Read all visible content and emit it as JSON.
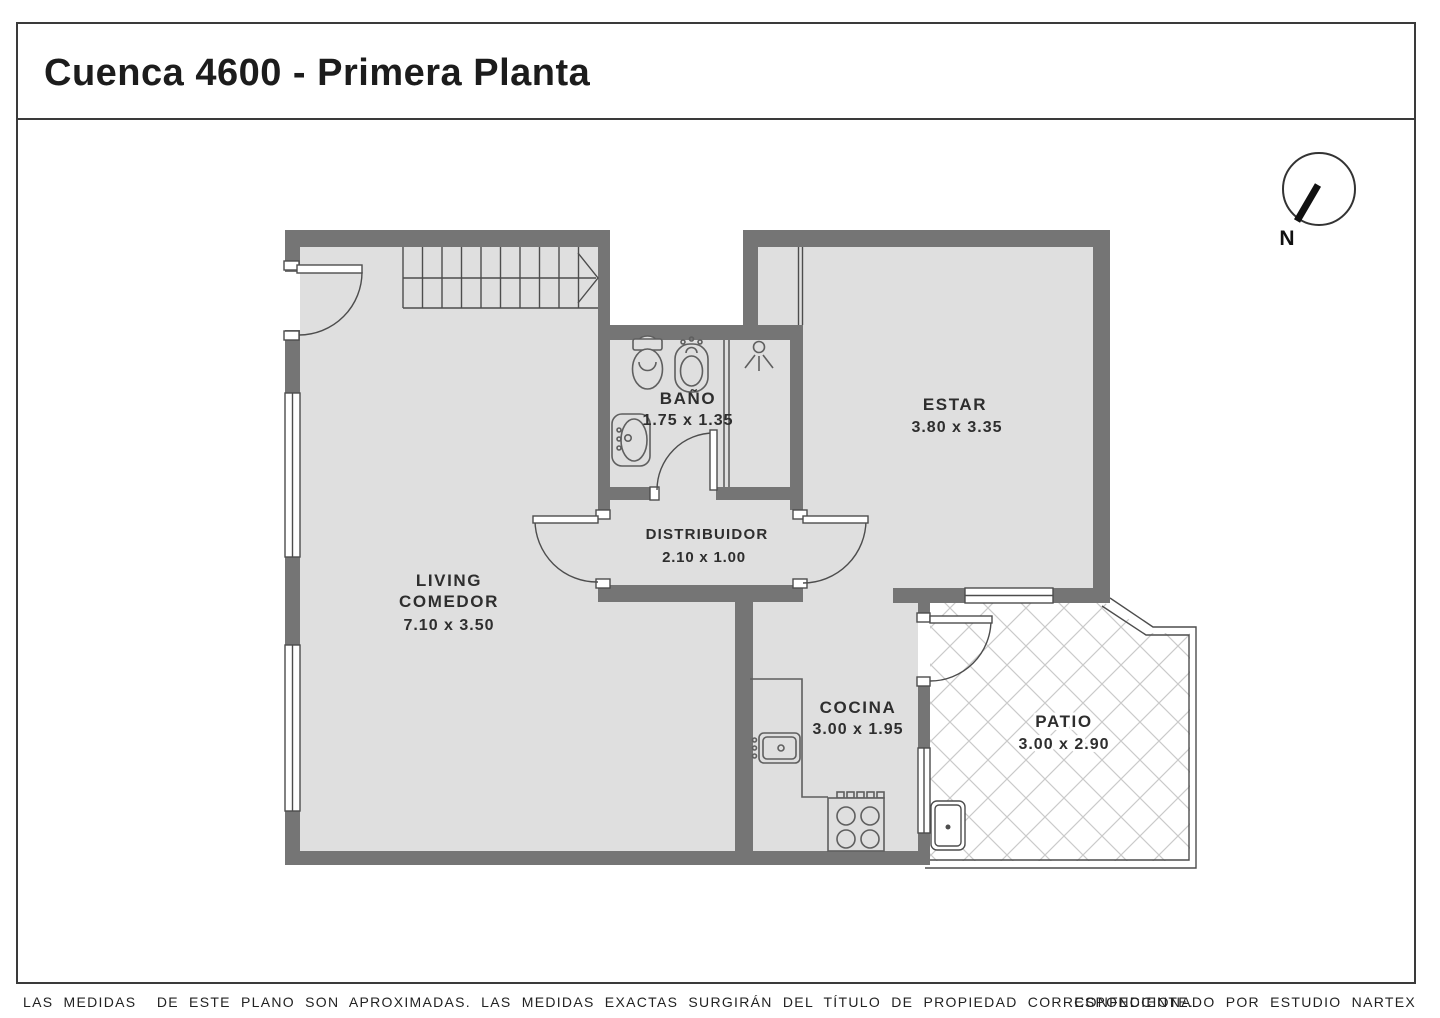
{
  "title": "Cuenca 4600 - Primera Planta",
  "compass": {
    "label": "N"
  },
  "rooms": {
    "living": {
      "line1": "LIVING",
      "line2": "COMEDOR",
      "dims": "7.10 x 3.50"
    },
    "bano": {
      "name": "BAÑO",
      "dims": "1.75 x 1.35"
    },
    "distribuidor": {
      "name": "DISTRIBUIDOR",
      "dims": "2.10 x 1.00"
    },
    "estar": {
      "name": "ESTAR",
      "dims": "3.80 x 3.35"
    },
    "cocina": {
      "name": "COCINA",
      "dims": "3.00 x 1.95"
    },
    "patio": {
      "name": "PATIO",
      "dims": "3.00 x 2.90"
    }
  },
  "footer": {
    "disclaimer": "LAS MEDIDAS  DE ESTE PLANO SON APROXIMADAS. LAS MEDIDAS EXACTAS SURGIRÁN DEL TÍTULO DE PROPIEDAD CORRESPONDIENTE.",
    "credit": "CONFECCIONADO POR ESTUDIO NARTEX"
  },
  "colors": {
    "wall": "#757575",
    "floor": "#dfdfdf",
    "line": "#4d4d4d",
    "hatch": "#cacaca"
  }
}
